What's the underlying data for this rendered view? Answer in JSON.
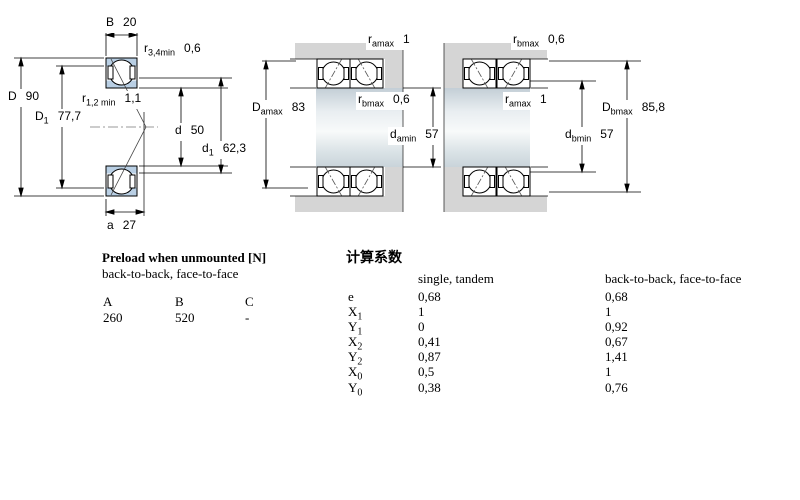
{
  "fig1": {
    "B": {
      "sym": "B",
      "val": "20"
    },
    "r34": {
      "sym": "r",
      "sub": "3,4min",
      "val": "0,6"
    },
    "D": {
      "sym": "D",
      "val": "90"
    },
    "D1": {
      "sym": "D",
      "sub": "1",
      "val": "77,7"
    },
    "r12": {
      "sym": "r",
      "sub": "1,2 min",
      "val": "1,1"
    },
    "d": {
      "sym": "d",
      "val": "50"
    },
    "d1": {
      "sym": "d",
      "sub": "1",
      "val": "62,3"
    },
    "a": {
      "sym": "a",
      "val": "27"
    }
  },
  "fig2": {
    "ramax": {
      "sym": "r",
      "sub": "amax",
      "val": "1"
    },
    "rbmax": {
      "sym": "r",
      "sub": "bmax",
      "val": "0,6"
    },
    "Damax": {
      "sym": "D",
      "sub": "amax",
      "val": "83"
    },
    "damin": {
      "sym": "d",
      "sub": "amin",
      "val": "57"
    }
  },
  "fig3": {
    "rbmax": {
      "sym": "r",
      "sub": "bmax",
      "val": "0,6"
    },
    "ramax": {
      "sym": "r",
      "sub": "amax",
      "val": "1"
    },
    "Dbmax": {
      "sym": "D",
      "sub": "bmax",
      "val": "85,8"
    },
    "dbmin": {
      "sym": "d",
      "sub": "bmin",
      "val": "57"
    }
  },
  "preload": {
    "title": "Preload when unmounted [N]",
    "subtitle": "back-to-back, face-to-face",
    "columns": [
      "A",
      "B",
      "C"
    ],
    "values": [
      "260",
      "520",
      "-"
    ]
  },
  "factors": {
    "title": "计算系数",
    "col1": "single, tandem",
    "col2": "back-to-back, face-to-face",
    "rows": [
      {
        "sym": "e",
        "sub": "",
        "v1": "0,68",
        "v2": "0,68"
      },
      {
        "sym": "X",
        "sub": "1",
        "v1": "1",
        "v2": "1"
      },
      {
        "sym": "Y",
        "sub": "1",
        "v1": "0",
        "v2": "0,92"
      },
      {
        "sym": "X",
        "sub": "2",
        "v1": "0,41",
        "v2": "0,67"
      },
      {
        "sym": "Y",
        "sub": "2",
        "v1": "0,87",
        "v2": "1,41"
      },
      {
        "sym": "X",
        "sub": "0",
        "v1": "0,5",
        "v2": "1"
      },
      {
        "sym": "Y",
        "sub": "0",
        "v1": "0,38",
        "v2": "0,76"
      }
    ]
  },
  "colors": {
    "ring_blue": "#b9cfe4",
    "housing_gray": "#d5d5d5"
  }
}
